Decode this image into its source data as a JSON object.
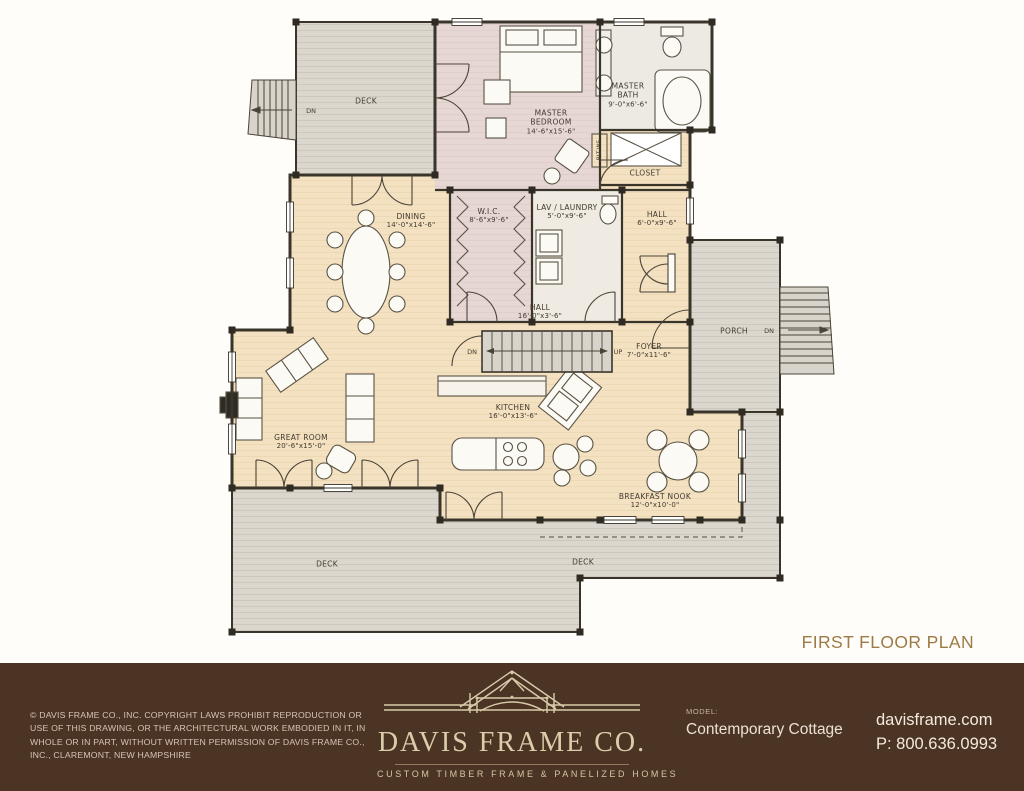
{
  "plan": {
    "title": "FIRST FLOOR PLAN",
    "rooms": {
      "deck_top": {
        "name": "DECK"
      },
      "master_bedroom": {
        "name": "MASTER BEDROOM",
        "dims": "14'-6\"x15'-6\""
      },
      "master_bath": {
        "name": "MASTER BATH",
        "dims": "9'-0\"x6'-6\""
      },
      "closet": {
        "name": "CLOSET"
      },
      "built_ins": {
        "name": "BLT-INS"
      },
      "dining": {
        "name": "DINING",
        "dims": "14'-0\"x14'-6\""
      },
      "wic": {
        "name": "W.I.C.",
        "dims": "8'-6\"x9'-6\""
      },
      "lav_laundry": {
        "name": "LAV / LAUNDRY",
        "dims": "5'-0\"x9'-6\""
      },
      "hall_upper": {
        "name": "HALL",
        "dims": "6'-0\"x9'-6\""
      },
      "hall_lower": {
        "name": "HALL",
        "dims": "16'-0\"x3'-6\""
      },
      "porch": {
        "name": "PORCH"
      },
      "foyer": {
        "name": "FOYER",
        "dims": "7'-0\"x11'-6\""
      },
      "kitchen": {
        "name": "KITCHEN",
        "dims": "16'-0\"x13'-6\""
      },
      "great_room": {
        "name": "GREAT ROOM",
        "dims": "20'-6\"x15'-0\""
      },
      "breakfast_nook": {
        "name": "BREAKFAST NOOK",
        "dims": "12'-0\"x10'-0\""
      },
      "deck_bottom_left": {
        "name": "DECK"
      },
      "deck_bottom_right": {
        "name": "DECK"
      }
    },
    "stair_labels": {
      "dn_deck": "DN",
      "dn_main": "DN",
      "up_main": "UP",
      "dn_porch": "DN"
    }
  },
  "footer": {
    "copyright": "© DAVIS FRAME CO., INC. COPYRIGHT LAWS PROHIBIT REPRODUCTION OR USE OF THIS DRAWING, OR THE ARCHITECTURAL WORK EMBODIED IN IT, IN WHOLE OR IN PART, WITHOUT WRITTEN PERMISSION OF DAVIS FRAME CO., INC., CLAREMONT, NEW HAMPSHIRE",
    "logo_name": "DAVIS FRAME CO.",
    "logo_tagline": "CUSTOM TIMBER FRAME & PANELIZED HOMES",
    "model_label": "MODEL:",
    "model_name": "Contemporary Cottage",
    "website": "davisframe.com",
    "phone": "P: 800.636.0993"
  },
  "colors": {
    "footer_bg": "#4c3424",
    "floor_tan": "#f4e1c2",
    "bedroom_mauve": "#e6d7d4",
    "deck_gray": "#dbd7cf",
    "wall": "#3a352b",
    "title_text": "#9e7b45",
    "logo_cream": "#dbcdab"
  }
}
